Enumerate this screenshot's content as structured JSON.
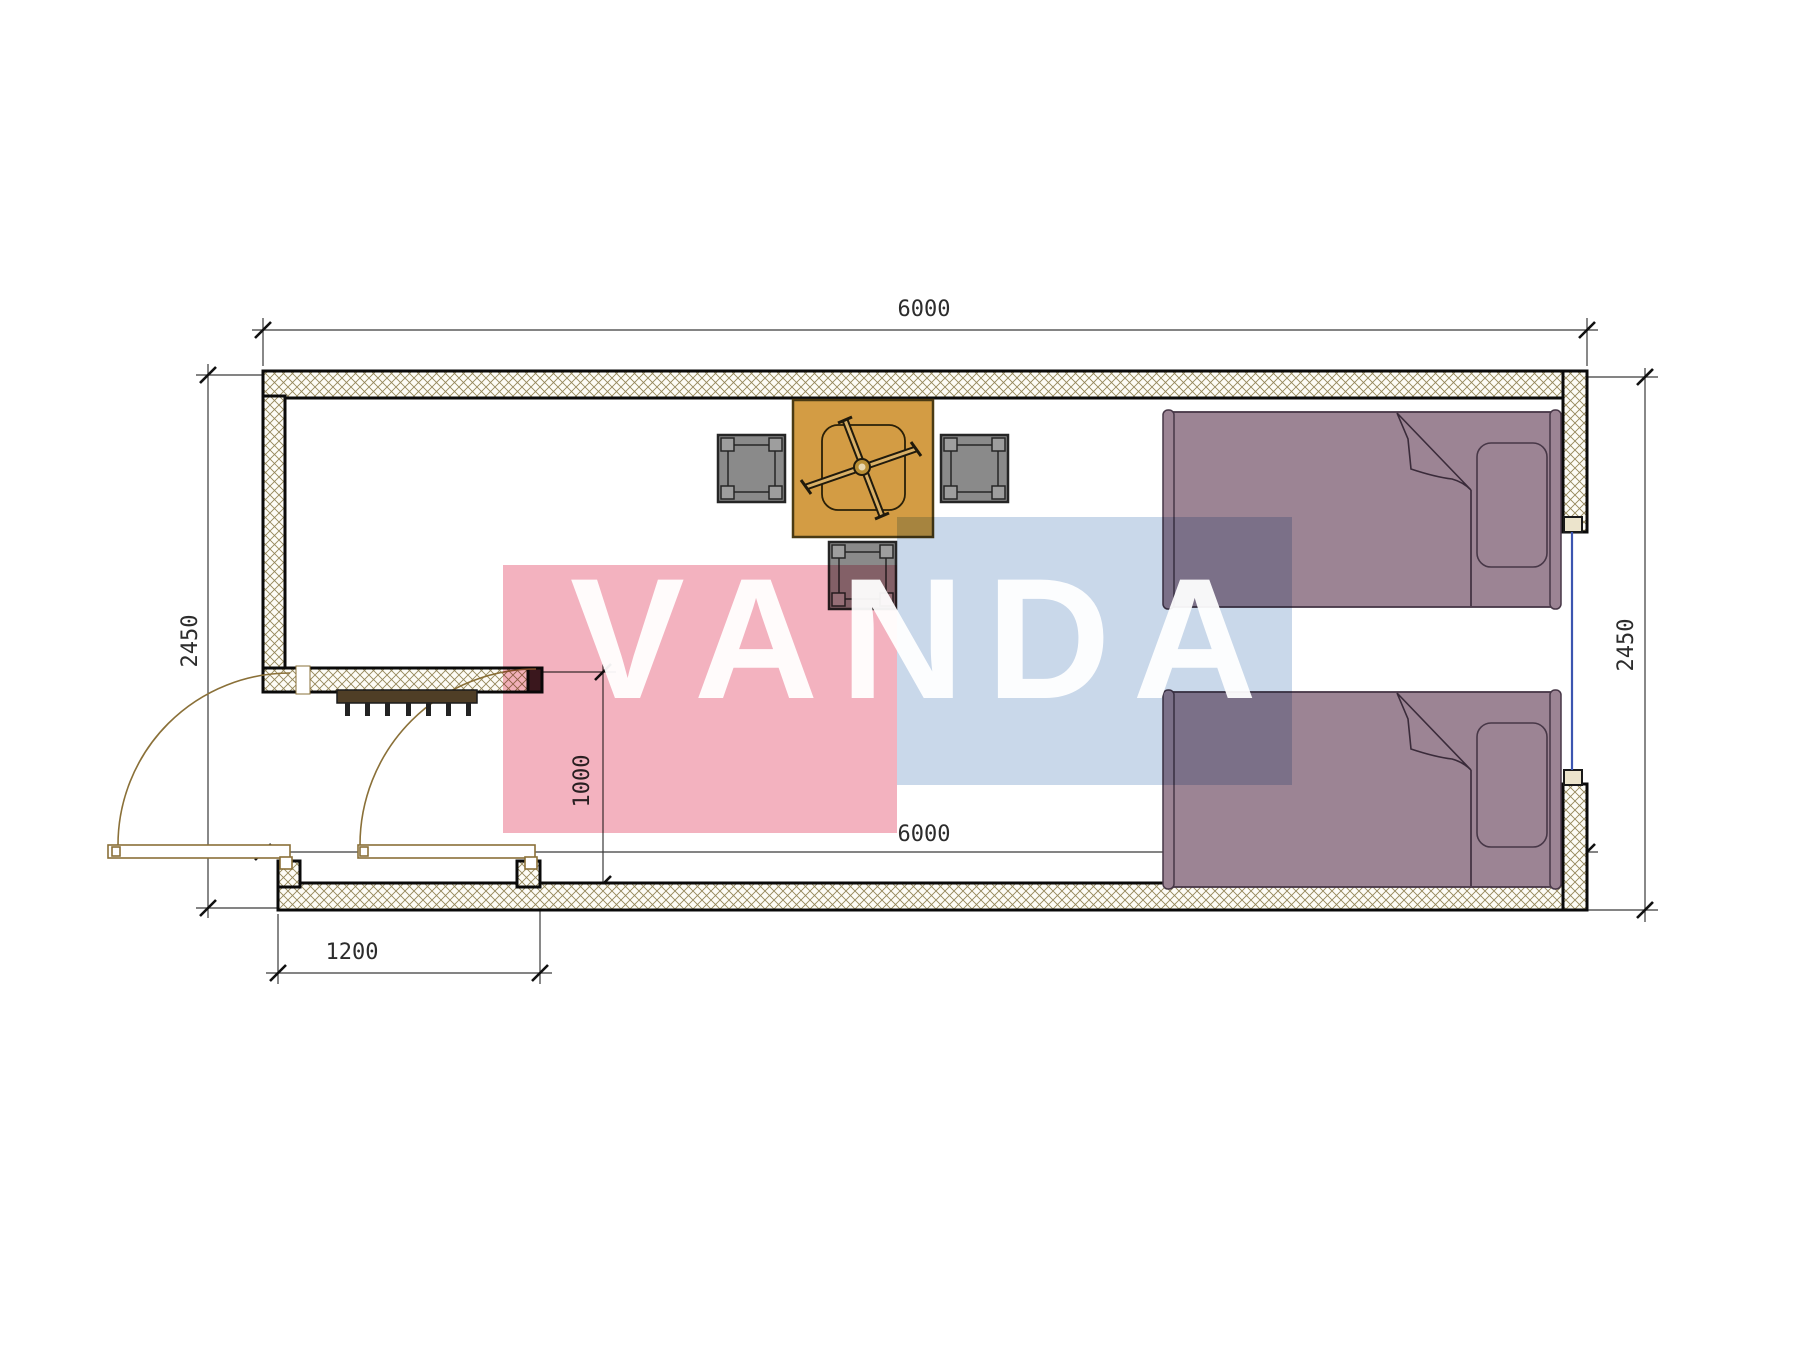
{
  "drawing": {
    "type": "floor-plan",
    "unit": "mm",
    "dimensions": {
      "top_width": "6000",
      "bottom_width": "6000",
      "left_height": "2450",
      "right_height": "2450",
      "door_opening": "1000",
      "entry_width": "1200"
    },
    "rooms": {
      "main_room_furniture": [
        "table",
        "stool-left",
        "stool-right",
        "stool-bottom",
        "bed-1",
        "bed-2"
      ],
      "vestibule_features": [
        "entry-door",
        "interior-door",
        "floor-grate"
      ]
    },
    "colors": {
      "wall_hatch": "#94875a",
      "wall_line": "#0a0a0a",
      "table_fill": "#d39c44",
      "table_line": "#4a3a14",
      "stool_fill": "#8a8a8a",
      "stool_corner": "#9e9e9e",
      "stool_line": "#262626",
      "bed_fill": "#9c8494",
      "bed_line": "#473747",
      "door_line": "#8a7038",
      "grate_fill": "#4f3e26",
      "window_glass": "#3c55b0",
      "dim_line": "#3a3a3a"
    }
  },
  "watermark": {
    "text": "VANDA",
    "pink_color": "#f2a8b6",
    "blue_color": "#c2d3e8"
  }
}
